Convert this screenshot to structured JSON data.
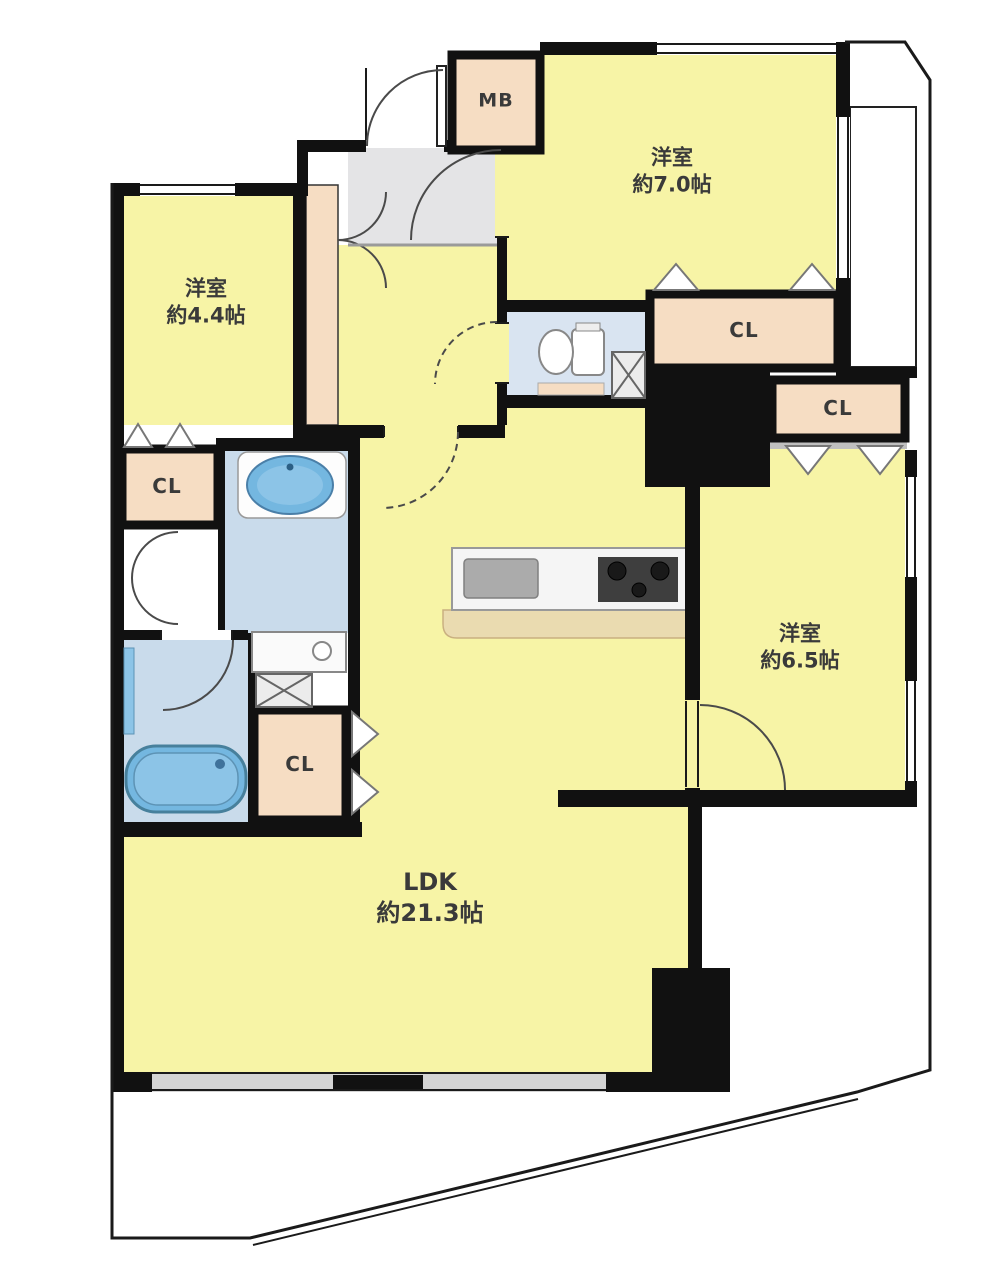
{
  "floorplan": {
    "rooms": {
      "bedroom_a": {
        "label": "洋室",
        "area": "約7.0帖"
      },
      "bedroom_b": {
        "label": "洋室",
        "area": "約4.4帖"
      },
      "bedroom_c": {
        "label": "洋室",
        "area": "約6.5帖"
      },
      "ldk": {
        "label": "LDK",
        "area": "約21.3帖"
      }
    },
    "storage": {
      "meter_box": "MB",
      "closet_hall": "CL",
      "closet_bedroom_a": "CL",
      "closet_bedroom_c": "CL",
      "closet_washroom": "CL"
    },
    "colors": {
      "room_yellow": "#F7F4A6",
      "closet_peach": "#F6DDC3",
      "entrance_gray": "#E4E4E6",
      "wet_area_blue": "#C9DBEB",
      "fixture_blue": "#74B7E0",
      "counter_tan": "#EADBB0",
      "wall_black": "#111111"
    }
  }
}
